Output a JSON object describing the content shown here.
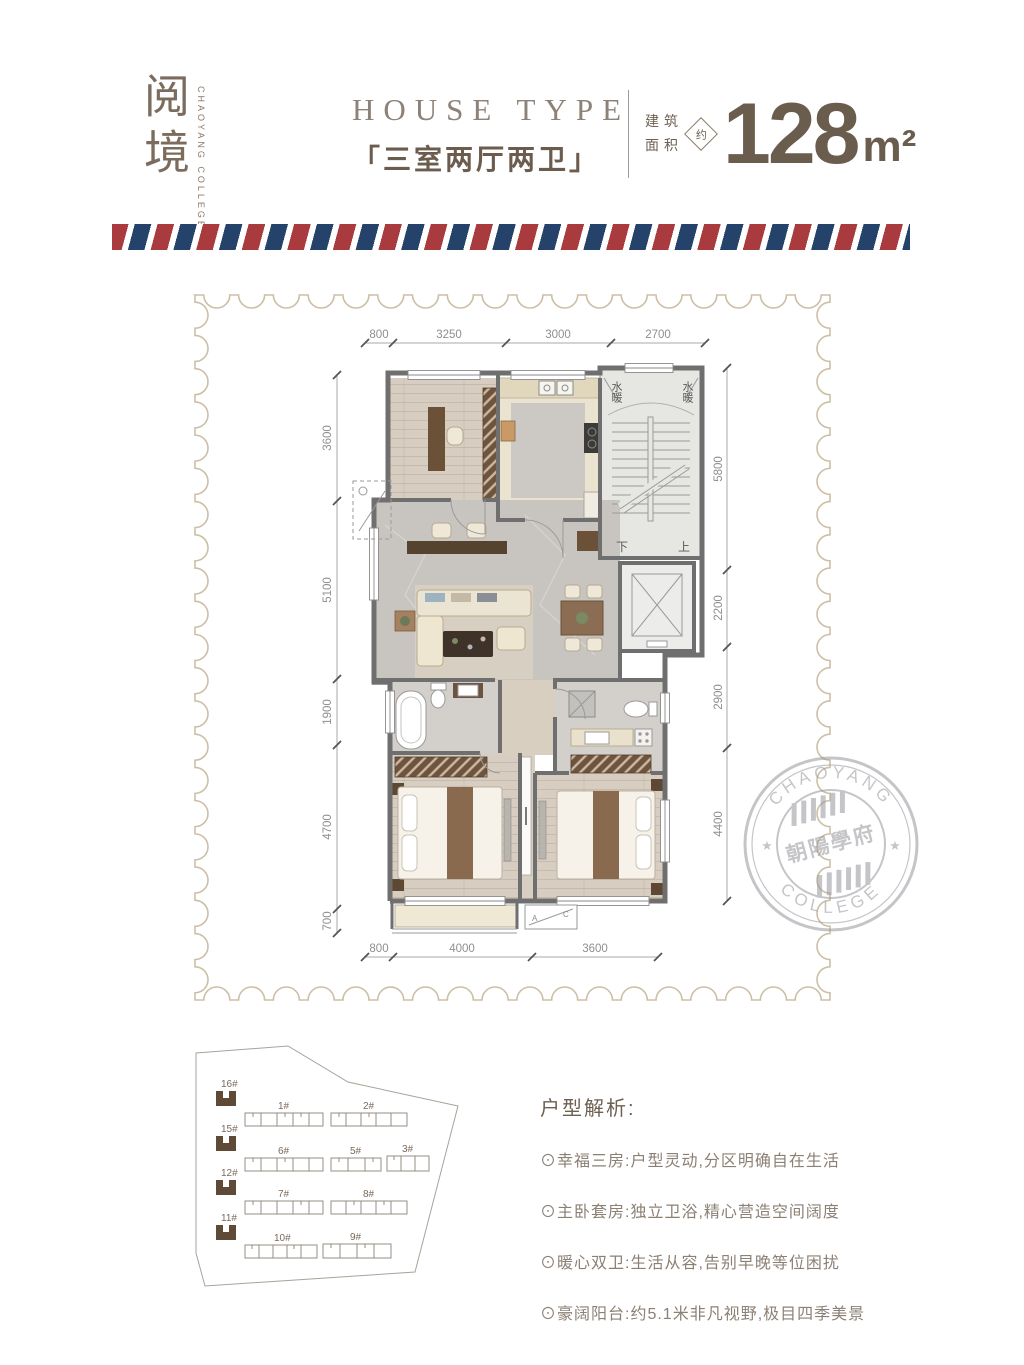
{
  "brand": {
    "logo": "阅境",
    "logo_sub": "CHAOYANG COLLEGE"
  },
  "header": {
    "house_type_en": "HOUSE TYPE",
    "house_type_cn": "「三室两厅两卫」",
    "area_label_line1": "建筑",
    "area_label_line2": "面积",
    "area_approx": "约",
    "area_value": "128",
    "area_unit": "m²"
  },
  "plan": {
    "dims_top": [
      "800",
      "3250",
      "3000",
      "2700"
    ],
    "dims_left": [
      "3600",
      "5100",
      "1900",
      "4700",
      "700"
    ],
    "dims_right": [
      "5800",
      "2200",
      "2900",
      "4400"
    ],
    "dims_bottom": [
      "800",
      "4000",
      "3600"
    ],
    "labels": {
      "water_heating": "水暖",
      "stairs_down": "下",
      "stairs_up": "上",
      "ac_a": "A",
      "ac_c": "C"
    }
  },
  "stamp": {
    "arc_top": "CHAOYANG",
    "arc_bottom": "COLLEGE",
    "center": "朝陽學府",
    "star_left": "★",
    "star_right": "★"
  },
  "siteplan": {
    "highlighted": [
      "16#",
      "15#",
      "12#",
      "11#"
    ],
    "rows": [
      [
        "1#",
        "2#"
      ],
      [
        "6#",
        "5#",
        "3#"
      ],
      [
        "7#",
        "8#"
      ],
      [
        "10#",
        "9#"
      ]
    ]
  },
  "analysis": {
    "title": "户型解析:",
    "bullets": [
      "⊙幸福三房:户型灵动,分区明确自在生活",
      "⊙主卧套房:独立卫浴,精心营造空间阔度",
      "⊙暖心双卫:生活从容,告别早晚等位困扰",
      "⊙豪阔阳台:约5.1米非凡视野,极目四季美景"
    ]
  },
  "colors": {
    "stripe-red": "#a93a3e",
    "stripe-navy": "#24426a",
    "brand-brown": "#6e6052",
    "muted-brown": "#8c8075",
    "line-tan": "#cdbfa6",
    "wall-gray": "#6f6f6f",
    "dim-gray": "#8f8f8f",
    "stamp-gray": "#97979d"
  }
}
